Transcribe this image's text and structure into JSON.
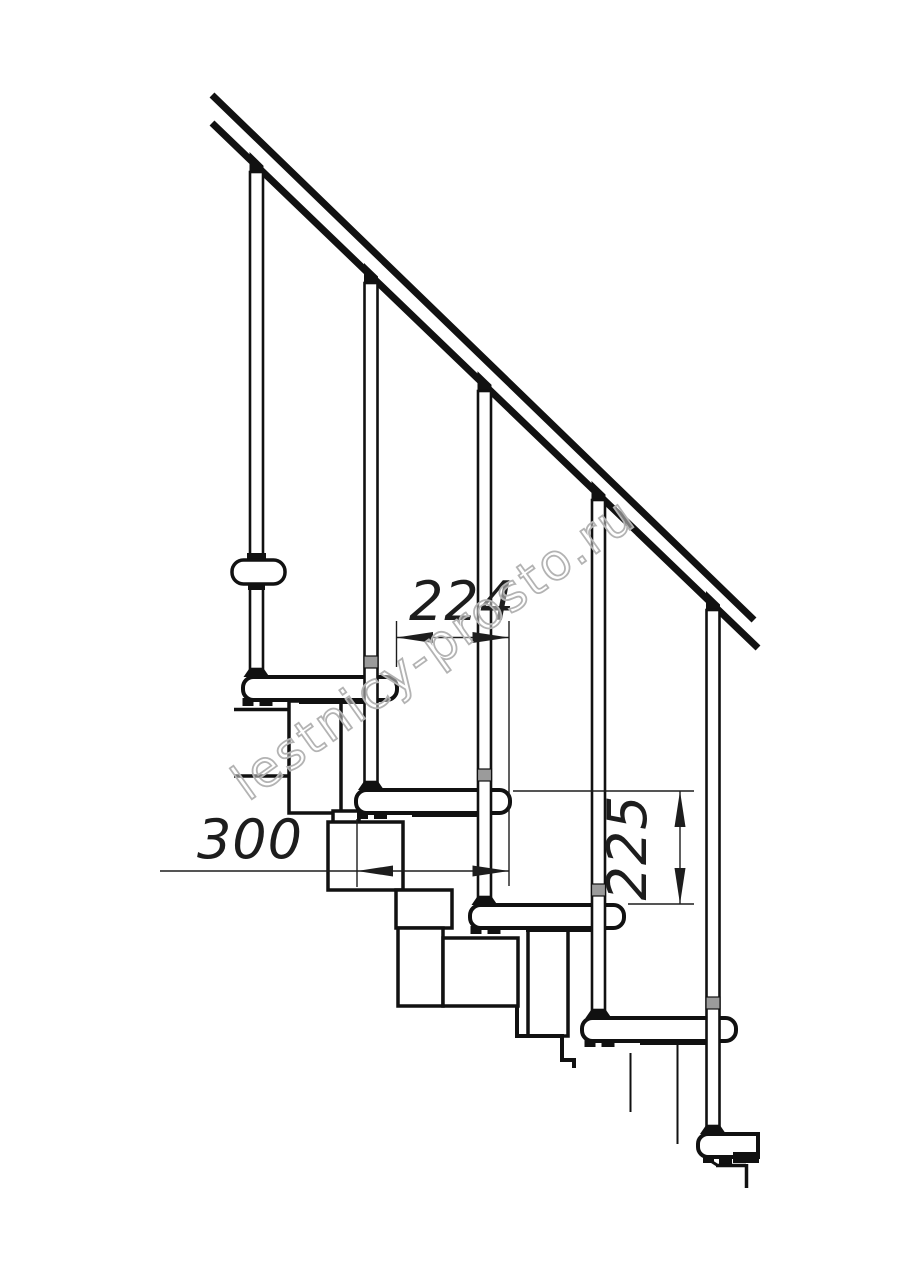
{
  "drawing": {
    "title": "Modular staircase side-view fragment",
    "dimensions": {
      "step_going_label": "224",
      "tread_depth_label": "300",
      "step_rise_label": "225"
    },
    "watermark": "lestnicy-prosto.ru",
    "colors": {
      "ink": "#111111",
      "dim_line": "#1d1d1d",
      "collar_gray": "#9b9b9b",
      "watermark_gray": "#b3b3b3",
      "background": "#ffffff"
    }
  }
}
